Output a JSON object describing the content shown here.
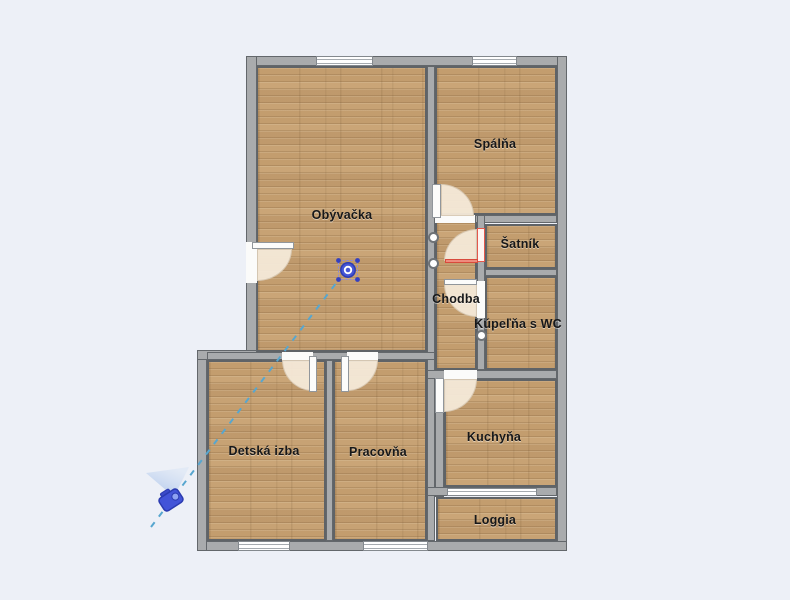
{
  "plan": {
    "rooms": [
      {
        "id": "obyvacka",
        "name": "Obývačka"
      },
      {
        "id": "spalna",
        "name": "Spálňa"
      },
      {
        "id": "satnik",
        "name": "Šatník"
      },
      {
        "id": "chodba",
        "name": "Chodba"
      },
      {
        "id": "kupelna",
        "name": "Kúpeľňa s WC"
      },
      {
        "id": "kuchyna",
        "name": "Kuchyňa"
      },
      {
        "id": "detska",
        "name": "Detská izba"
      },
      {
        "id": "pracovna",
        "name": "Pracovňa"
      },
      {
        "id": "loggia",
        "name": "Loggia"
      }
    ],
    "colors": {
      "background": "#edf0f7",
      "wall_fill": "#a9abad",
      "wall_stroke": "#63676b",
      "floor_wood": "#c6a173",
      "door_swing": "#f4e9d8",
      "selected_door": "#e4574b",
      "sightline": "#57a6cf",
      "marker_blue": "#4254d8"
    },
    "markers": {
      "viewpoint": "viewpoint-marker",
      "camera": "camera-marker",
      "selection_handles": 3
    }
  }
}
